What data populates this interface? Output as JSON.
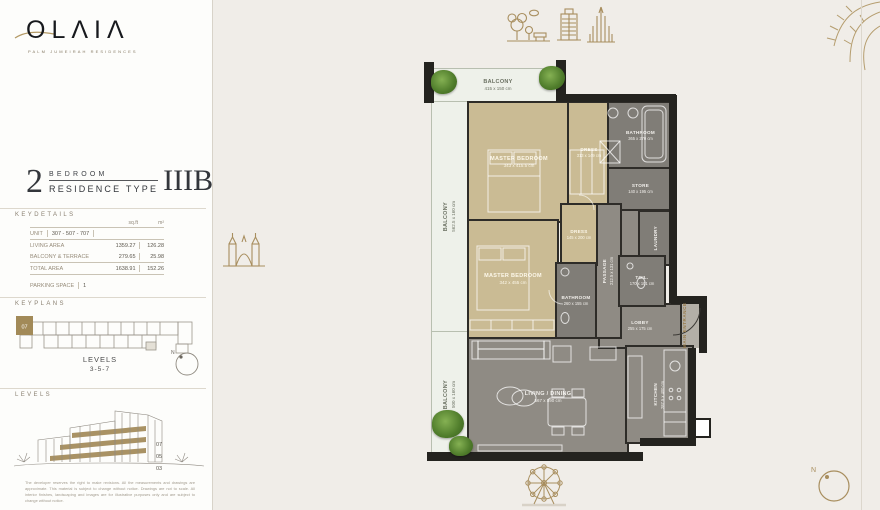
{
  "brand": {
    "logo": "OLΛIΛ",
    "tagline": "PALM JUMEIRAH RESIDENCES"
  },
  "title": {
    "number": "2",
    "word1": "BEDROOM",
    "word2": "RESIDENCE TYPE",
    "code": "IIIB"
  },
  "keydetails": {
    "heading": "KEYDETAILS",
    "col_sqft": "sq.ft",
    "col_sqm": "m²",
    "unit_label": "UNIT",
    "unit_value": "307 - 507 - 707",
    "rows": [
      {
        "label": "LIVING AREA",
        "sqft": "1359.27",
        "sqm": "126.28"
      },
      {
        "label": "BALCONY & TERRACE",
        "sqft": "279.65",
        "sqm": "25.98"
      },
      {
        "label": "TOTAL AREA",
        "sqft": "1638.91",
        "sqm": "152.26"
      }
    ],
    "parking_label": "PARKING SPACE",
    "parking_value": "1"
  },
  "keyplans": {
    "heading": "KEYPLANS",
    "unit_marker": "07",
    "levels_line1": "LEVELS",
    "levels_line2": "3-5-7",
    "compass_n": "N"
  },
  "levels": {
    "heading": "LEVELS",
    "floor_labels": [
      "07",
      "05",
      "03"
    ],
    "disclaimer": "The developer reserves the right to make revisions. All the measurements and drawings are approximate. This material is subject to change without notice. Drawings are not to scale. All interior finishes, landscaping and images are for illustrative purposes only and are subject to change without notice."
  },
  "plan": {
    "compass_n": "N",
    "main_entrance": "MAIN ENTRANCE",
    "rooms": {
      "balcony_top": {
        "name": "BALCONY",
        "dims": "415 x 150 cm"
      },
      "balcony_left": {
        "name": "BALCONY",
        "dims": "562.5 x 160 cm"
      },
      "master1": {
        "name": "MASTER BEDROOM",
        "dims": "343 x 415.5 cm"
      },
      "dress1": {
        "name": "DRESS",
        "dims": "313 x 149 cm"
      },
      "bath1": {
        "name": "BATHROOM",
        "dims": "365 x 270 cm"
      },
      "store": {
        "name": "STORE",
        "dims": "140 x 195 cm"
      },
      "master2": {
        "name": "MASTER BEDROOM",
        "dims": "342 x 455 cm"
      },
      "dress2": {
        "name": "DRESS",
        "dims": "145 x 200 cm"
      },
      "passage": {
        "name": "PASSAGE",
        "dims": "212.5 x 131 cm"
      },
      "laundry": {
        "name": "LAUNDRY",
        "dims": ""
      },
      "bath2": {
        "name": "BATHROOM",
        "dims": "260 x 155 cm"
      },
      "toilet": {
        "name": "TOIL.",
        "dims": "170 x 101 cm"
      },
      "lobby": {
        "name": "LOBBY",
        "dims": "255 x 175 cm"
      },
      "living": {
        "name": "LIVING / DINING",
        "dims": "567 x 590  cm"
      },
      "kitchen": {
        "name": "KITCHEN",
        "dims": "287.5 x 400 cm"
      },
      "balcony_bottom": {
        "name": "BALCONY",
        "dims": "500 x 160 cm"
      }
    }
  },
  "icons": {
    "landmarks": [
      "park-icon",
      "city-buildings-icon",
      "burj-khalifa-icon",
      "arch-monument-icon",
      "ferris-wheel-icon",
      "palm-frond-icon"
    ]
  },
  "colors": {
    "gold_accent": "#a68c5d",
    "wall": "#24231f",
    "bedroom_floor": "#cabb94",
    "wet_floor": "#807d77",
    "living_floor": "#8f8b84",
    "balcony_floor": "#eef1ea",
    "page_bg": "#f0ede8"
  }
}
